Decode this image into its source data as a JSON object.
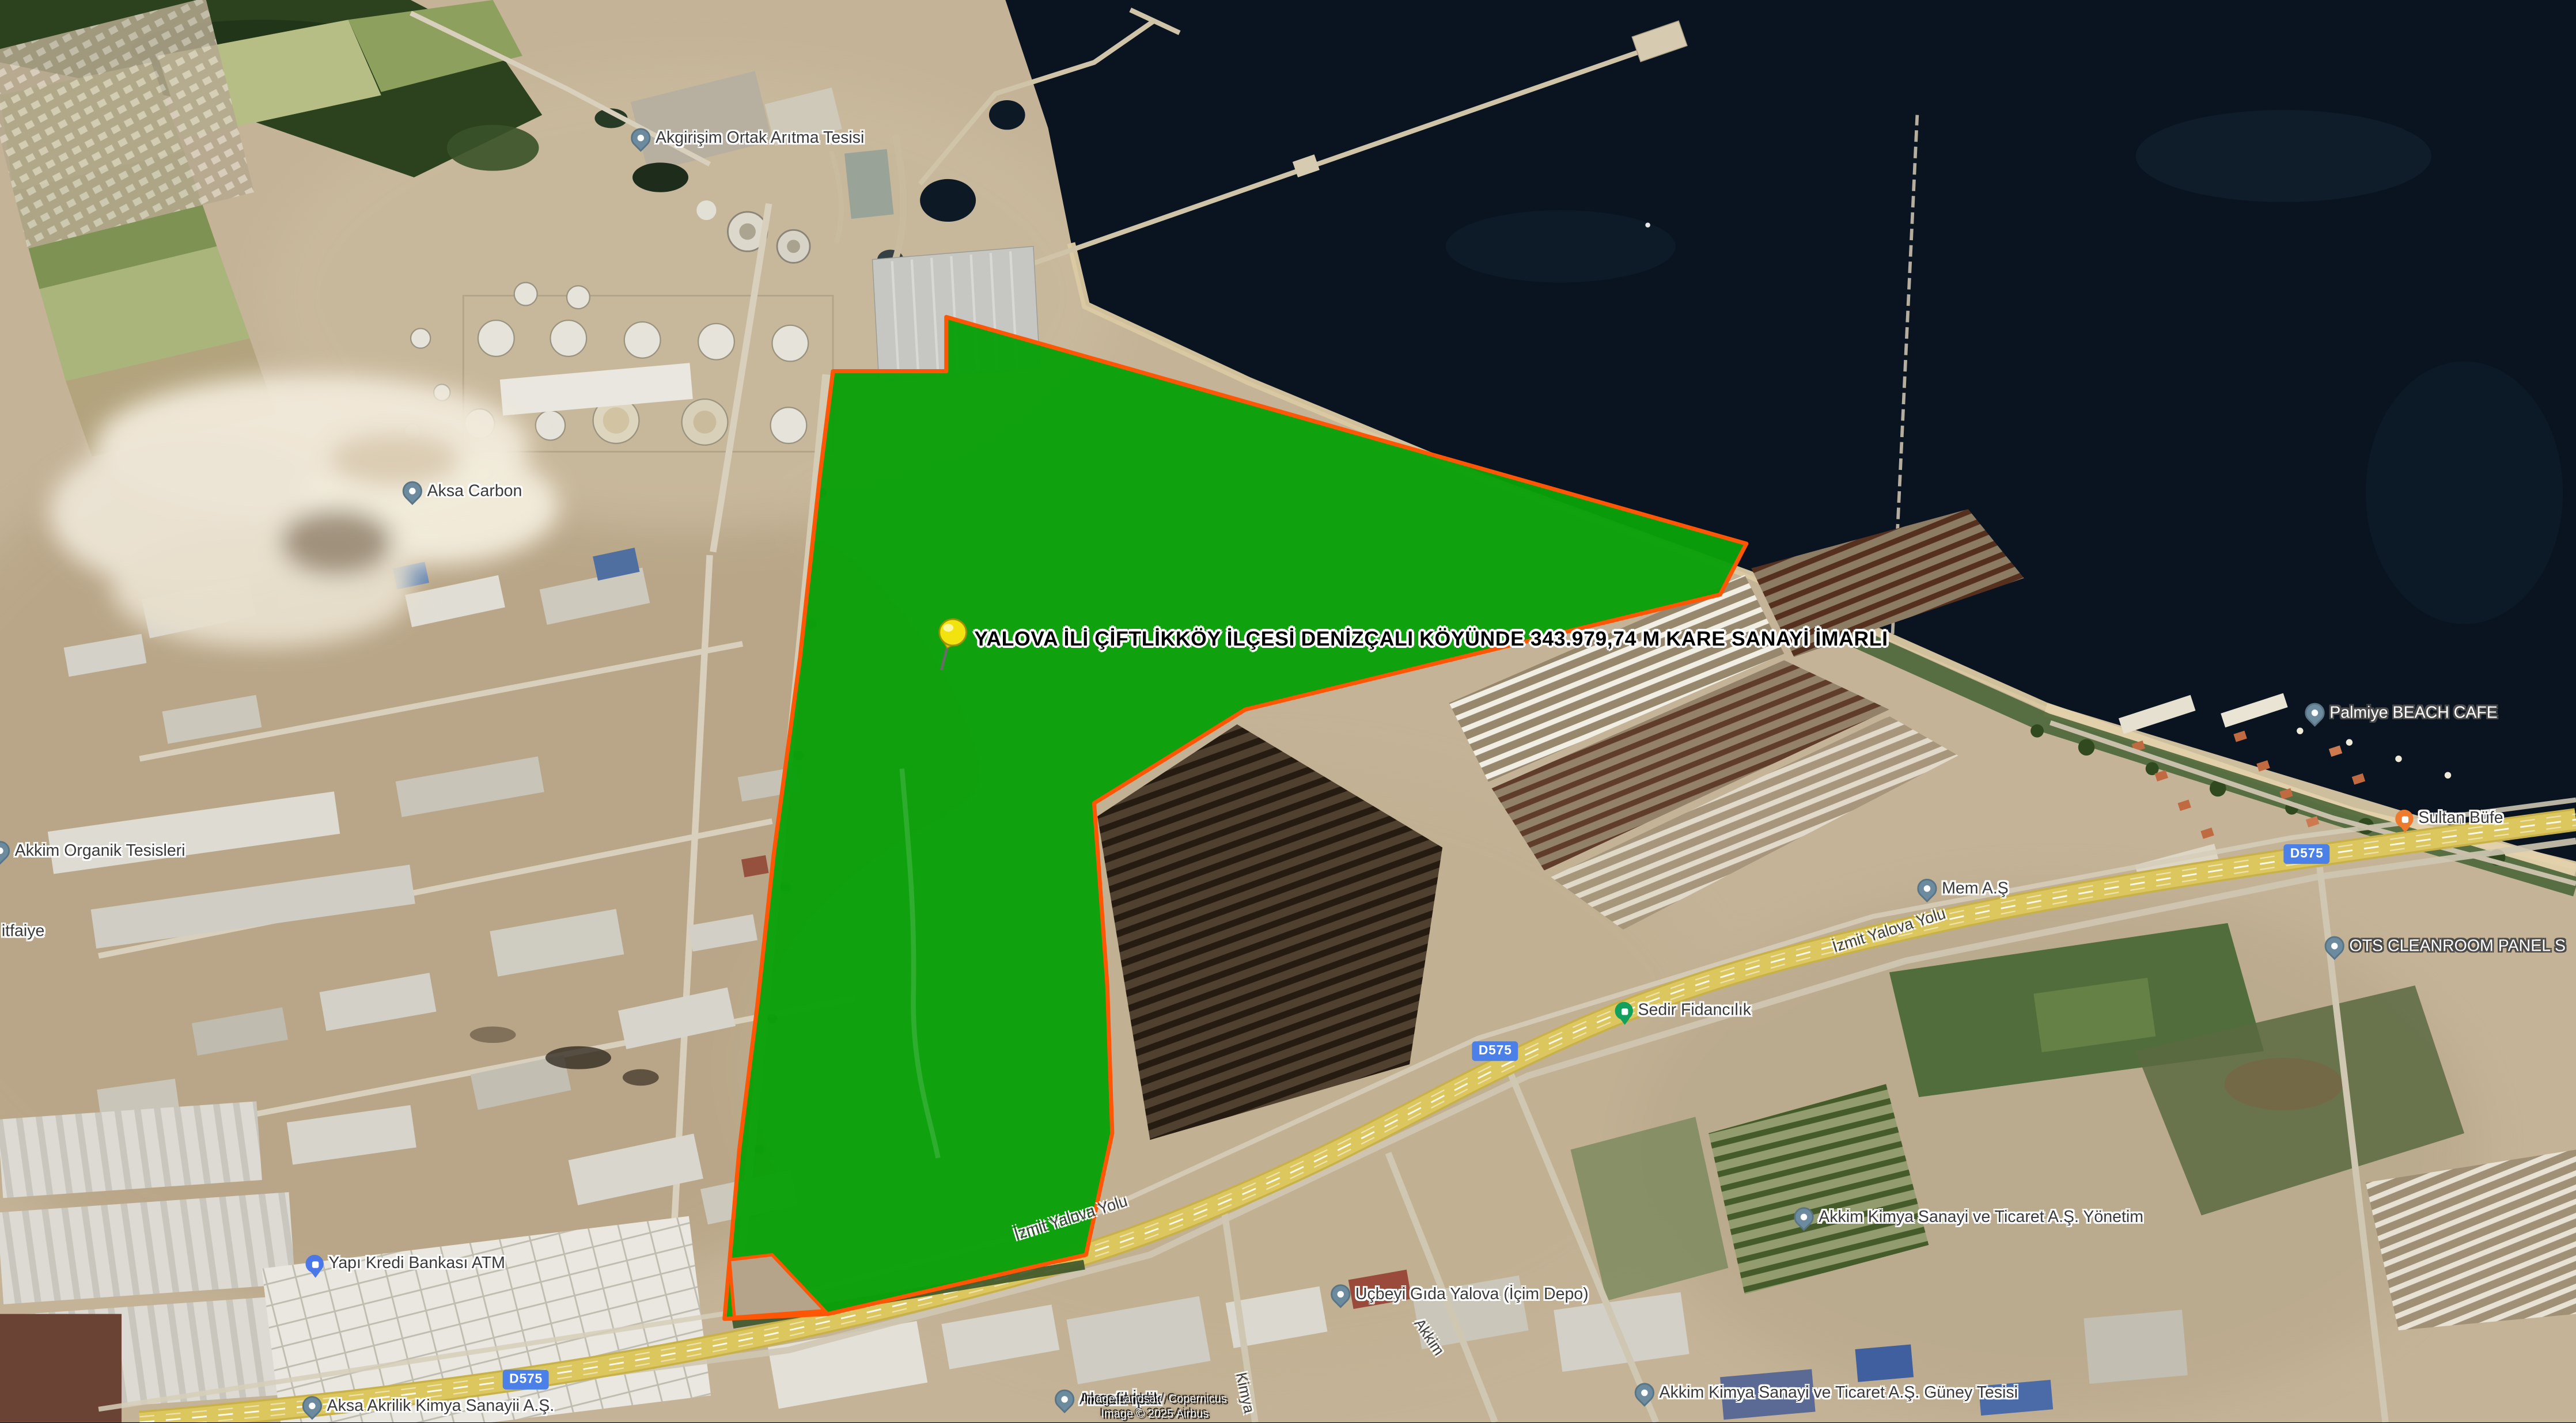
{
  "overlay": {
    "parcel_label": "YALOVA İLİ ÇİFTLİKKÖY İLÇESİ DENİZÇALI KÖYÜNDE 343.979,74 M KARE SANAYİ İMARLI"
  },
  "pois": [
    {
      "id": "akgirisim",
      "text": "Akgirişim Ortak Arıtma Tesisi",
      "pin": "default-pin-icon"
    },
    {
      "id": "aksa-carbon",
      "text": "Aksa Carbon",
      "pin": "default-pin-icon"
    },
    {
      "id": "akkim-organik",
      "text": "Akkim Organik Tesisleri",
      "pin": "default-pin-icon"
    },
    {
      "id": "itfaiye",
      "text": "itfaiye",
      "pin": "none"
    },
    {
      "id": "yapi-kredi",
      "text": "Yapı Kredi Bankası ATM",
      "pin": "bank-pin-icon"
    },
    {
      "id": "aksa-akrilik",
      "text": "Aksa Akrilik Kimya Sanayii A.Ş.",
      "pin": "default-pin-icon"
    },
    {
      "id": "aksafil",
      "text": "Aksafil İplik",
      "pin": "default-pin-icon"
    },
    {
      "id": "ucbeyi",
      "text": "Uçbeyi Gıda Yalova (İçim Depo)",
      "pin": "default-pin-icon"
    },
    {
      "id": "akkim-yonetim",
      "text": "Akkim Kimya Sanayi ve Ticaret A.Ş. Yönetim",
      "pin": "default-pin-icon"
    },
    {
      "id": "akkim-guney",
      "text": "Akkim Kimya Sanayi ve Ticaret A.Ş. Güney Tesisi",
      "pin": "default-pin-icon"
    },
    {
      "id": "sedir",
      "text": "Sedir Fidancılık",
      "pin": "tree-pin-icon"
    },
    {
      "id": "mem",
      "text": "Mem A.Ş",
      "pin": "default-pin-icon"
    },
    {
      "id": "palmiye",
      "text": "Palmiye BEACH CAFE",
      "pin": "default-pin-icon"
    },
    {
      "id": "sultan",
      "text": "Sultan Büfe",
      "pin": "food-pin-icon"
    },
    {
      "id": "ots",
      "text": "OTS CLEANROOM PANEL S",
      "pin": "default-pin-icon"
    }
  ],
  "road": {
    "badges": [
      {
        "text": "D575"
      },
      {
        "text": "D575"
      },
      {
        "text": "D575"
      }
    ],
    "names": [
      {
        "text": "İzmit Yalova Yolu"
      },
      {
        "text": "İzmit Yalova Yolu"
      },
      {
        "text": "Kimya"
      },
      {
        "text": "Akkim"
      }
    ]
  },
  "attribution": {
    "line1": "Image Landsat / Copernicus",
    "line2": "Image © 2025 Airbus"
  },
  "colors": {
    "parcel_fill": "#0AA00A",
    "parcel_border": "#FF5606",
    "sea": "#0A1420",
    "highway_yellow": "#DCC65E",
    "route_badge_blue": "#4A80E8",
    "default_pin": "#6D8B9E",
    "bank_pin": "#4A78E8",
    "food_pin": "#EE7A2E",
    "tree_pin": "#12A05C",
    "pushpin_yellow": "#F2E30E"
  }
}
